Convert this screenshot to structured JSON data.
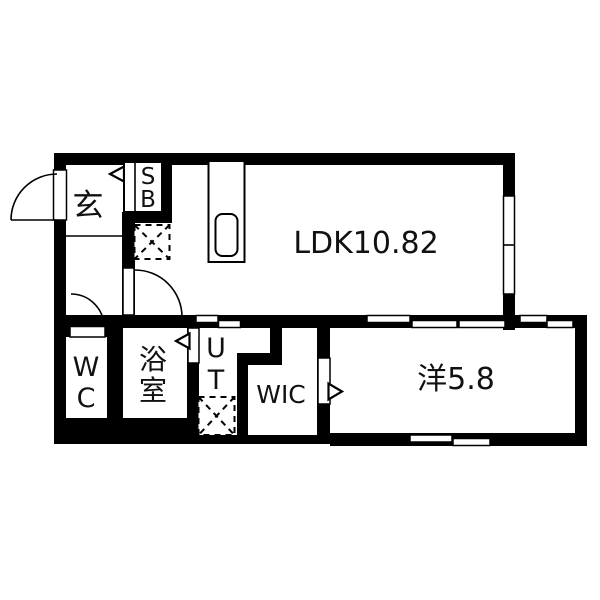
{
  "title": "apartment-floorplan",
  "colors": {
    "wall": "#000000",
    "background": "#ffffff",
    "text": "#111111"
  },
  "rooms": {
    "ldk": {
      "label": "LDK10.82"
    },
    "bedroom": {
      "label": "洋5.8"
    },
    "entrance": {
      "label": "玄"
    },
    "shoebox": {
      "line1": "S",
      "line2": "B"
    },
    "wc": {
      "line1": "W",
      "line2": "C"
    },
    "bath": {
      "line1": "浴",
      "line2": "室"
    },
    "utility": {
      "line1": "U",
      "line2": "T"
    },
    "wic": {
      "label": "WIC"
    }
  },
  "symbols": {
    "entrance_door": "entrance-door-swing",
    "hall_door": "interior-door-swing",
    "wc_door": "wc-door-swing",
    "bath_door": "folding-door-marker",
    "wic_door": "folding-door-marker",
    "shoebox_door": "folding-door-marker",
    "fridge": "refrigerator-space",
    "washer": "washing-machine-space",
    "kitchen": "kitchen-counter",
    "sink": "kitchen-sink",
    "sliding_doors": "sliding-door-panels",
    "windows": "window-panels"
  }
}
